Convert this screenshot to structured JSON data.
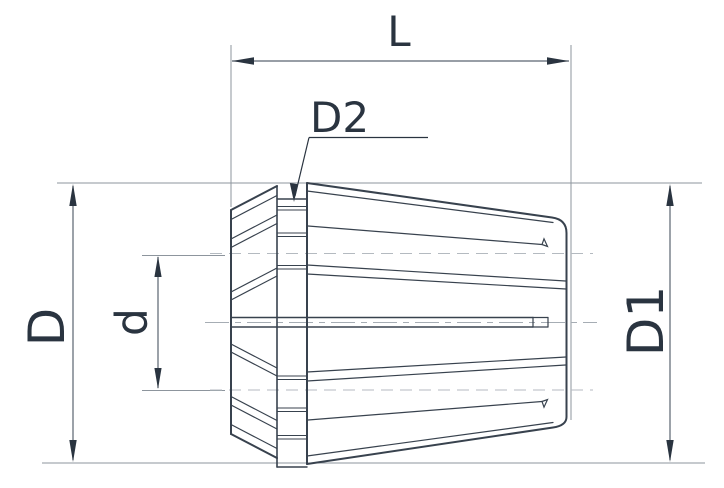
{
  "figure": {
    "type": "technical-dimension-drawing",
    "subject": "ER collet side view with dimension callouts",
    "labels": {
      "length": "L",
      "groove_diameter": "D2",
      "outer_diameter": "D",
      "bore_diameter": "d",
      "front_diameter": "D1"
    },
    "colors": {
      "background": "#ffffff",
      "outline": "#38424e",
      "dimension_line": "#5a6470",
      "reference_line": "#8d959d",
      "hidden_dash": "#b4bac0",
      "centerline": "#a6adb4",
      "text": "#2a3440"
    }
  }
}
